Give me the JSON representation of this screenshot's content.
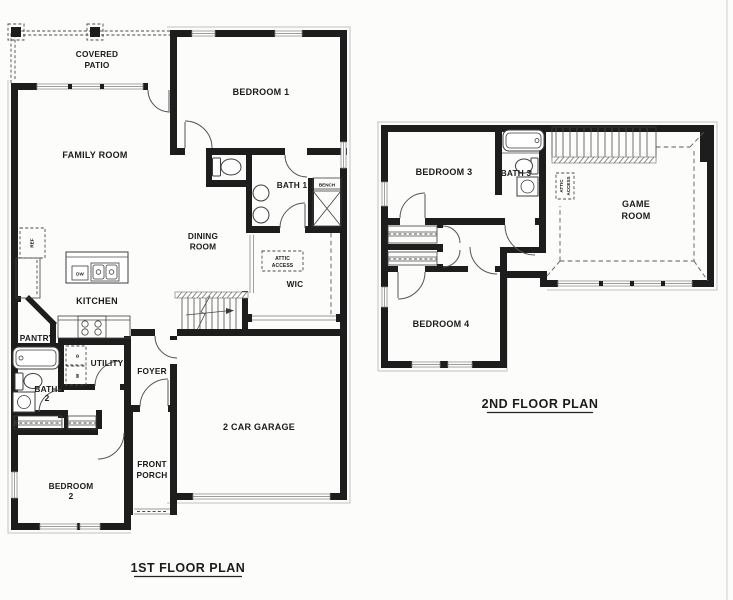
{
  "sheet": {
    "colors": {
      "paper": "#fcfcfb",
      "wall": "#1d1d1d",
      "ink": "#1b1b1b"
    }
  },
  "floor1": {
    "title": "1ST FLOOR PLAN",
    "labels": {
      "covered_patio_1": "COVERED",
      "covered_patio_2": "PATIO",
      "family_room": "FAMILY ROOM",
      "bedroom1": "BEDROOM 1",
      "bath1": "BATH 1",
      "bench": "BENCH",
      "dining_1": "DINING",
      "dining_2": "ROOM",
      "attic_1": "ATTIC",
      "attic_2": "ACCESS",
      "wic": "WIC",
      "kitchen": "KITCHEN",
      "ref": "REF",
      "dw": "DW",
      "pantry": "PANTRY",
      "utility": "UTILITY",
      "dryer": "D",
      "washer": "W",
      "bath2_1": "BATH",
      "bath2_2": "2",
      "foyer": "FOYER",
      "bedroom2_1": "BEDROOM",
      "bedroom2_2": "2",
      "front_porch_1": "FRONT",
      "front_porch_2": "PORCH",
      "garage": "2 CAR GARAGE"
    }
  },
  "floor2": {
    "title": "2ND FLOOR PLAN",
    "labels": {
      "bedroom3": "BEDROOM 3",
      "bath3": "BATH 3",
      "attic_1": "ATTIC",
      "attic_2": "ACCESS",
      "game_1": "GAME",
      "game_2": "ROOM",
      "bedroom4": "BEDROOM 4"
    }
  }
}
